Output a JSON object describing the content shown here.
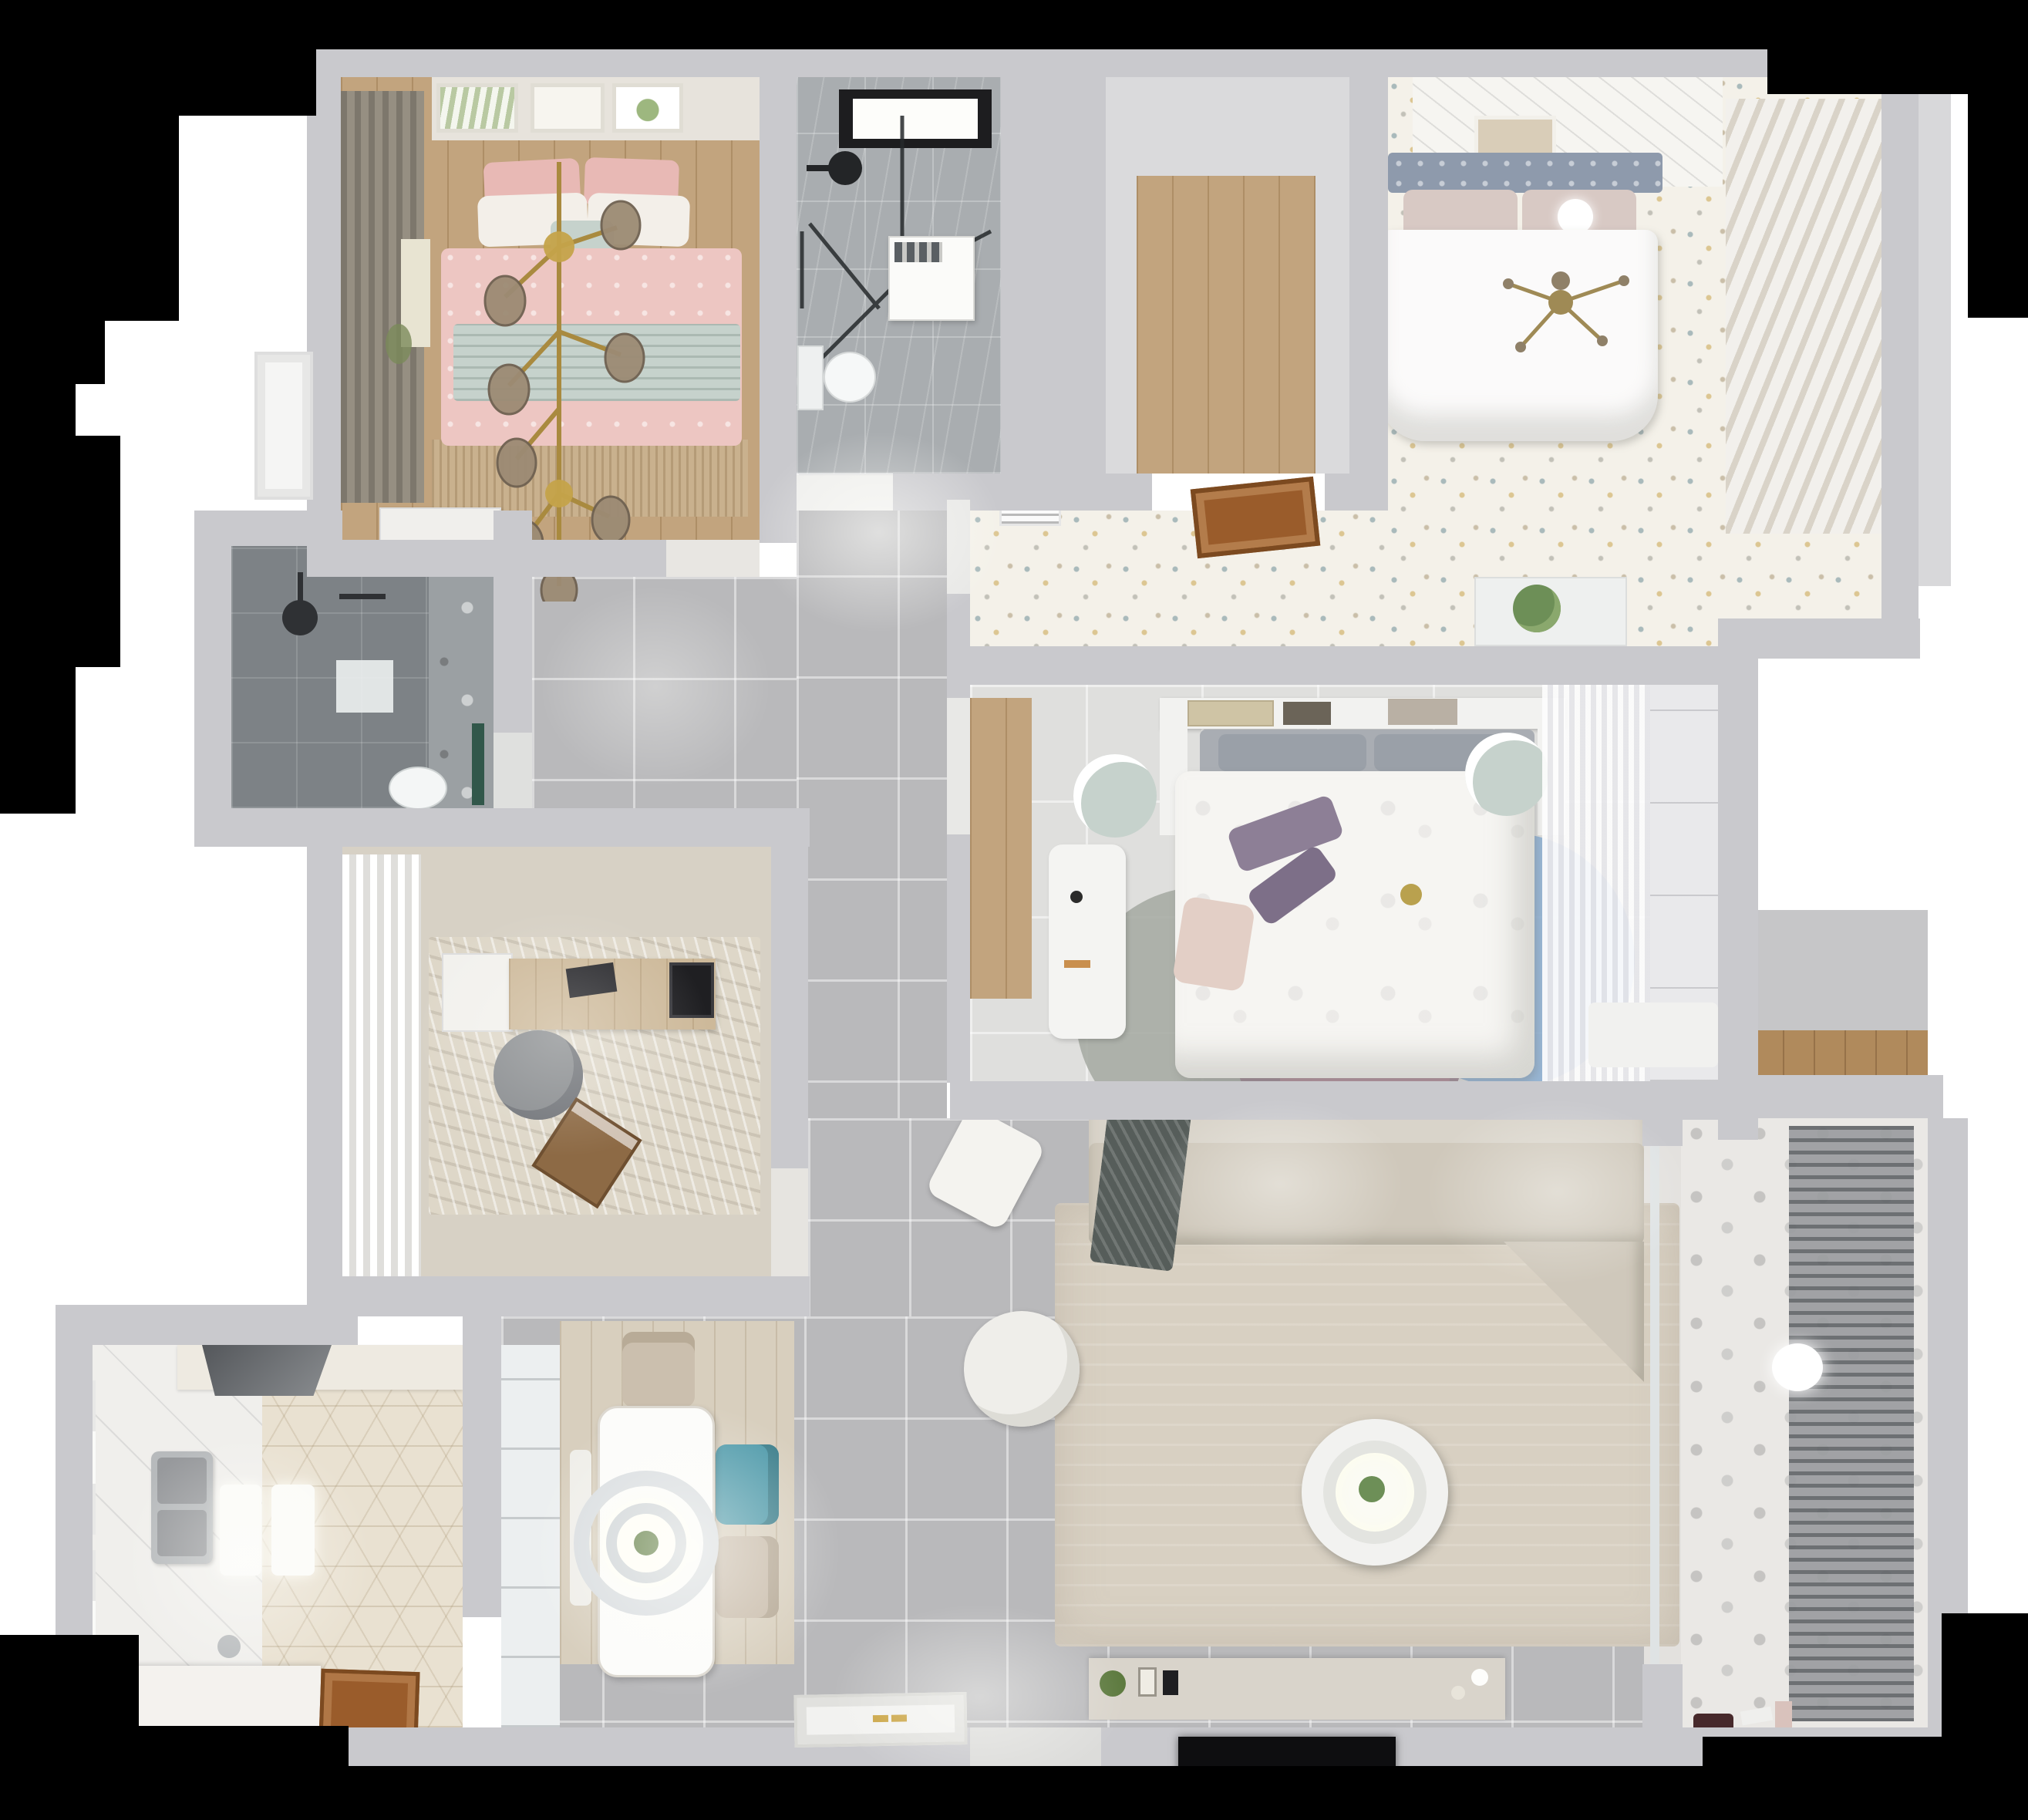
{
  "title": "top-down-3d-apartment-floor-plan-render",
  "visible_text": [],
  "palette": {
    "wall": "#c9c9cd",
    "wallLight": "#d8d8da",
    "black": "#000000",
    "tile": "#b9b9bb",
    "floor2": "#dfdfdd",
    "speckleBase": "#f4f1e9",
    "wood": "#c2a47e",
    "woodDark": "#9a5c2b",
    "marble": "#a9adb0",
    "darkTile": "#7d8286",
    "hexFloor": "#e9e1d1",
    "whiteTile": "#f0efec",
    "studyFloor": "#d7d1c5",
    "pink": "#edc6c2",
    "pinkDeep": "#e8b9b5",
    "mint": "#c6d2cc",
    "duvet": "#fbfafa",
    "sofa": "#cfc8bb",
    "rug": "#d8d0c2",
    "teal": "#4f9aaa",
    "gold": "#b08c3f",
    "balconyFloor": "#eae8e5",
    "steel": "#b7babc",
    "console": "#d9d4cb"
  },
  "rooms": [
    {
      "id": "bedroom-pink",
      "name": "pink bedroom (top-left)",
      "furniture": [
        "double-bed-pink-bedding",
        "mint-blanket",
        "pillows",
        "gold-branch-chandelier",
        "wall-art-frames",
        "dark-curtains",
        "wood-floor",
        "white-dresser"
      ]
    },
    {
      "id": "bathroom-main",
      "name": "bathroom (top-middle)",
      "furniture": [
        "black-frame-window",
        "shower-glass-enclosure",
        "black-shower-head",
        "washing-machine",
        "toilet",
        "marble-floor"
      ]
    },
    {
      "id": "walkin-closet",
      "name": "walk-in closet (top-middle-right)",
      "furniture": [
        "wood-floor-panel"
      ]
    },
    {
      "id": "bedroom-master",
      "name": "master bedroom (top-right)",
      "furniture": [
        "double-bed-white-duvet",
        "gray-headboard",
        "blush-pillows",
        "sphere-pendant-lamp",
        "gold-cross-chandelier",
        "louver-wardrobe",
        "confetti-speckle-floor",
        "ceiling-plank-band",
        "wall-art",
        "side-window-door"
      ]
    },
    {
      "id": "vestibule",
      "name": "suite vestibule",
      "furniture": [
        "ac-vent-grille",
        "wood-hatch-panel",
        "plant-on-half-wall",
        "confetti-speckle-floor"
      ]
    },
    {
      "id": "bedroom-middle",
      "name": "middle bedroom",
      "furniture": [
        "bed-floral-duvet",
        "purple-pillows",
        "headboard-bridge-shelf",
        "books",
        "mint-round-stools",
        "white-desk",
        "wood-wardrobe-strip",
        "multicircle-rug",
        "sheer-curtains",
        "white-wardrobe",
        "white-mat"
      ]
    },
    {
      "id": "shower-room",
      "name": "second shower room (mid-left)",
      "furniture": [
        "dark-tile-floor",
        "window",
        "ceiling-shower-head",
        "bath-mat",
        "toilet",
        "green-glass-screen"
      ]
    },
    {
      "id": "study",
      "name": "study (mid-left)",
      "furniture": [
        "white-curtains",
        "desk",
        "office-chair",
        "laptop",
        "area-rug",
        "black-doormat"
      ]
    },
    {
      "id": "kitchen",
      "name": "kitchen (bottom-left)",
      "furniture": [
        "range-hood",
        "counter",
        "double-sink",
        "hex-tile-floor",
        "white-counter-block",
        "faucet",
        "wood-door",
        "windows"
      ]
    },
    {
      "id": "dining",
      "name": "dining area",
      "furniture": [
        "white-table",
        "wood-chair",
        "teal-chair",
        "beige-chair",
        "bench",
        "double-ring-pendant",
        "plank-rug",
        "tall-cabinet"
      ]
    },
    {
      "id": "living",
      "name": "living room",
      "furniture": [
        "sectional-sofa",
        "dark-throw",
        "beige-rug",
        "round-coffee-table",
        "white-pouf",
        "square-side-table",
        "tv-console",
        "flat-tv",
        "deco-plant",
        "photo-frames"
      ]
    },
    {
      "id": "entry",
      "name": "entry",
      "furniture": [
        "ornate-white-door-panel",
        "gold-handles"
      ]
    },
    {
      "id": "balcony",
      "name": "balcony / laundry (bottom-right)",
      "furniture": [
        "motif-tile-floor",
        "drying-rack-louvers",
        "sphere-light",
        "toys",
        "wood-shelf-niche"
      ]
    },
    {
      "id": "hallway",
      "name": "hallway / corridor",
      "furniture": [
        "gray-floor-tiles",
        "door-thresholds"
      ]
    }
  ]
}
